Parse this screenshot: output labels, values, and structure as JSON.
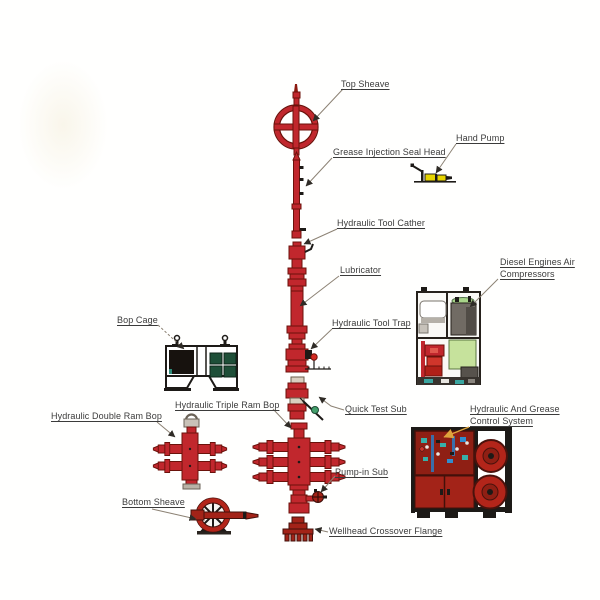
{
  "diagram": {
    "labels": {
      "top_sheave": "Top Sheave",
      "grease_injection_seal_head": "Grease Injection Seal Head",
      "hand_pump": "Hand Pump",
      "hydraulic_tool_cather": "Hydraulic Tool Cather",
      "lubricator": "Lubricator",
      "diesel_engines_air_compressors": "Diesel Engines Air Compressors",
      "bop_cage": "Bop Cage",
      "hydraulic_tool_trap": "Hydraulic Tool Trap",
      "hydraulic_triple_ram_bop": "Hydraulic Triple Ram Bop",
      "hydraulic_double_ram_bop": "Hydraulic Double Ram Bop",
      "quick_test_sub": "Quick Test Sub",
      "hydraulic_and_grease_control_system": "Hydraulic And Grease Control System",
      "pump_in_sub": "Pump-in Sub",
      "bottom_sheave": "Bottom Sheave",
      "wellhead_crossover_flange": "Wellhead Crossover Flange"
    },
    "colors": {
      "equipment_red": "#c1272d",
      "dark_red": "#a32318",
      "outline_dark": "#1d1a17",
      "pale_green_tank": "#c6e29c",
      "cage_green": "#1e4f38",
      "hand_pump_yellow": "#e6d400",
      "panel_teal": "#38b0a8",
      "leader_orange": "#dfa43c",
      "label_text": "#3b3b3b"
    }
  }
}
